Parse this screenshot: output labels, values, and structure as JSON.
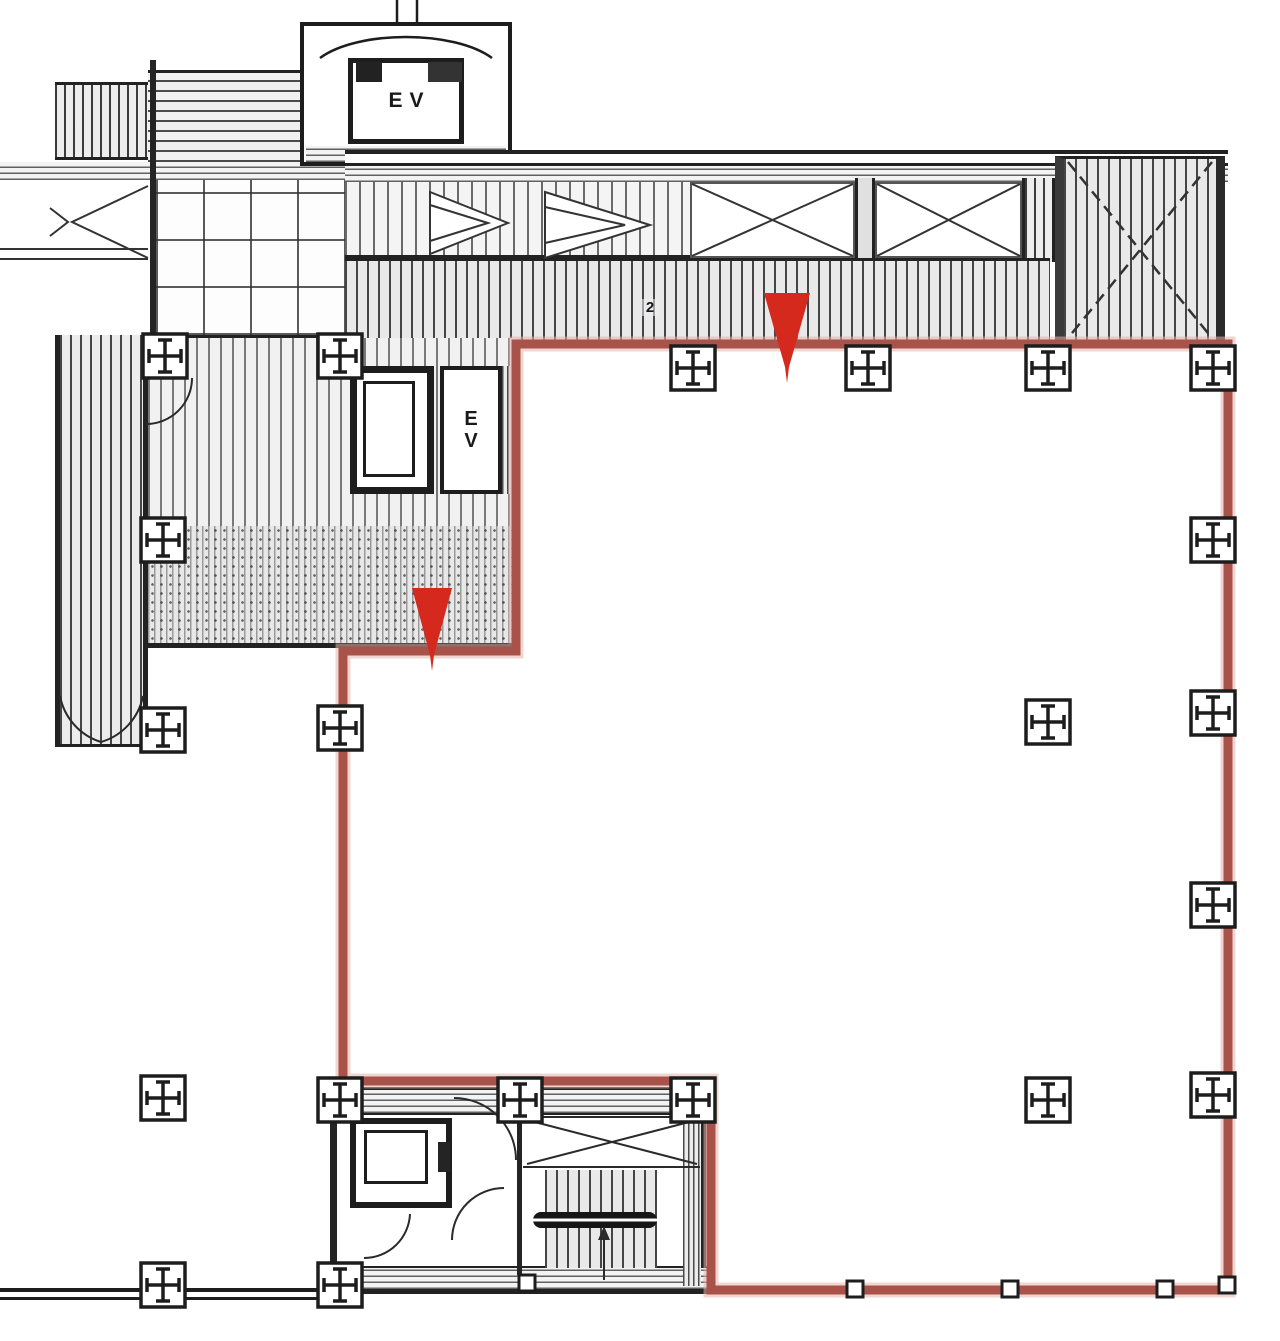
{
  "labels": {
    "elevator_top": "EV",
    "elevator_mid_line1": "E",
    "elevator_mid_line2": "V",
    "grid_note": "2"
  },
  "colors": {
    "line_black": "#1d1d1d",
    "boundary_red": "#a8524a",
    "boundary_halo": "#e2b4aa",
    "arrow_red": "#d5291d",
    "hatch_gray": "#3a3a3a"
  },
  "plan": {
    "boundary": {
      "closed": true,
      "stroke_width": 9,
      "points": [
        [
          516,
          344
        ],
        [
          1228,
          344
        ],
        [
          1228,
          1290
        ],
        [
          711,
          1290
        ],
        [
          711,
          1081
        ],
        [
          343,
          1081
        ],
        [
          343,
          651
        ],
        [
          516,
          651
        ]
      ]
    },
    "arrows": [
      {
        "cx": 787,
        "top": 293,
        "bottom": 383,
        "half_width": 23
      },
      {
        "cx": 432,
        "top": 588,
        "bottom": 671,
        "half_width": 20
      }
    ],
    "column_markers_cross": [
      [
        165,
        356
      ],
      [
        340,
        356
      ],
      [
        693,
        368
      ],
      [
        868,
        368
      ],
      [
        1048,
        368
      ],
      [
        1213,
        368
      ],
      [
        163,
        540
      ],
      [
        1213,
        540
      ],
      [
        163,
        730
      ],
      [
        340,
        728
      ],
      [
        1048,
        722
      ],
      [
        1213,
        713
      ],
      [
        1213,
        905
      ],
      [
        163,
        1098
      ],
      [
        340,
        1100
      ],
      [
        520,
        1100
      ],
      [
        693,
        1100
      ],
      [
        1048,
        1100
      ],
      [
        1213,
        1095
      ],
      [
        163,
        1285
      ],
      [
        340,
        1285
      ]
    ],
    "column_markers_small": [
      [
        527,
        1283
      ],
      [
        855,
        1289
      ],
      [
        1010,
        1289
      ],
      [
        1165,
        1289
      ],
      [
        1227,
        1285
      ]
    ]
  }
}
